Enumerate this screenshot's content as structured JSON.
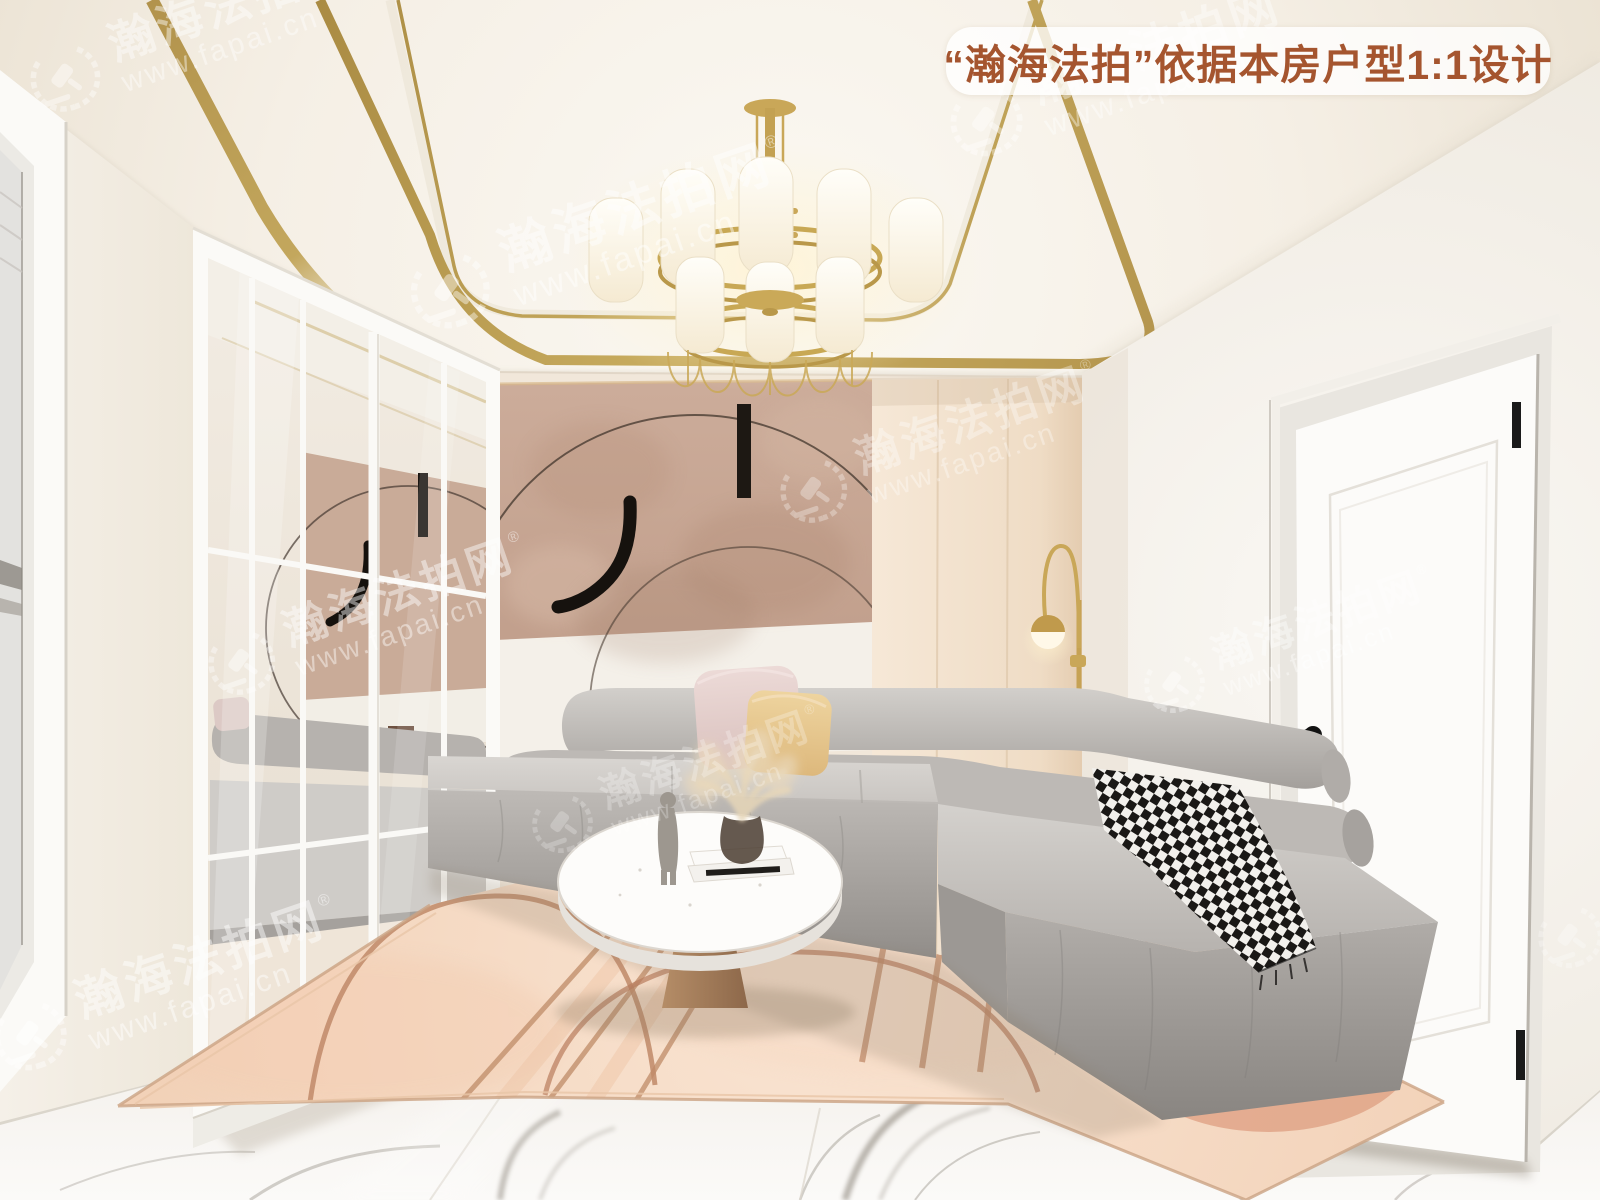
{
  "overlay": {
    "badge": {
      "text": "“瀚海法拍”依据本房户型1:1设计",
      "text_color": "#a5552f",
      "bg_color": "rgba(255,255,255,0.78)"
    },
    "watermark": {
      "emblem_icon": "laurel-gavel-emblem",
      "brand": "瀚海法拍网",
      "registered": "®",
      "url": "www.fapai.cn",
      "color": "#ffffff"
    }
  },
  "palette": {
    "ceiling_gold_trim": "#b5964c",
    "wall_white": "#f5f1ea",
    "accent_wall_blush": "#c9ab99",
    "cabinet_cream": "#f3e3d2",
    "sofa_gray": "#b7b3af",
    "pillow_pink": "#e5d1cf",
    "pillow_yellow": "#eace9a",
    "rug_blush": "#f5d8c4",
    "marble_white": "#f4f1ee",
    "lamp_gold": "#c9a758"
  }
}
